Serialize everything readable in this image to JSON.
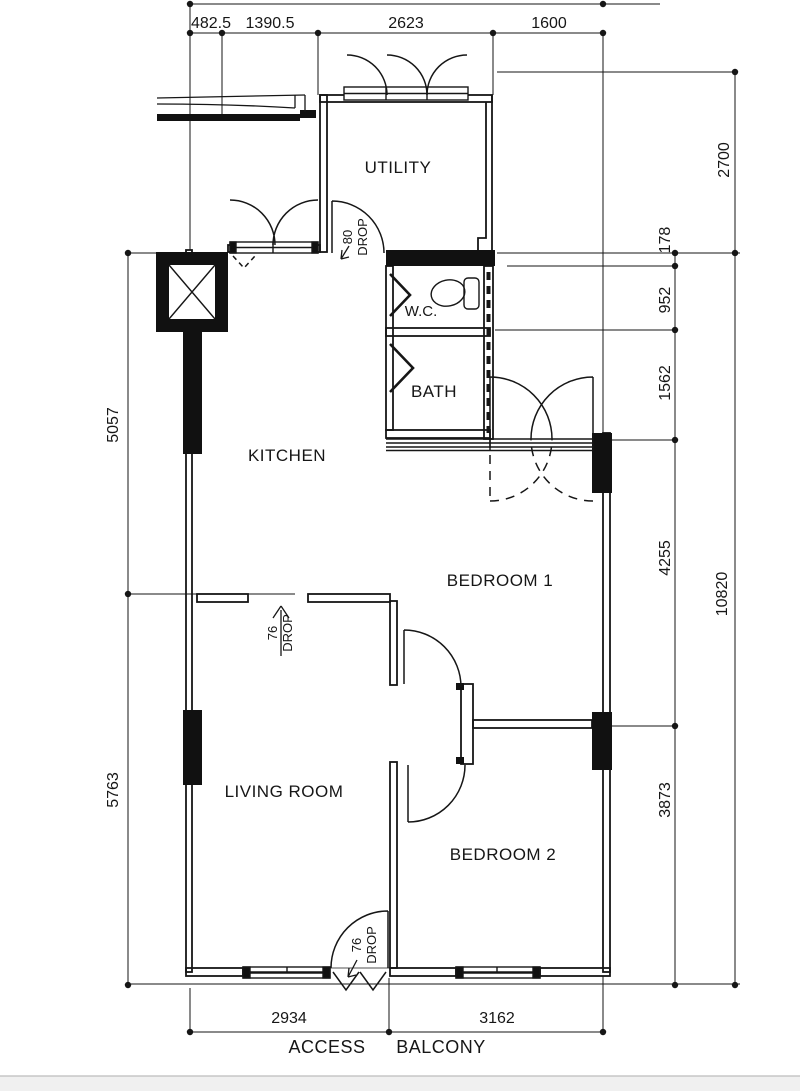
{
  "plan": {
    "title": "2-bedroom flat floor plan",
    "rooms": {
      "utility": "UTILITY",
      "kitchen": "KITCHEN",
      "wc": "W.C.",
      "bath": "BATH",
      "bedroom1": "BEDROOM 1",
      "bedroom2": "BEDROOM 2",
      "living": "LIVING ROOM"
    },
    "zones": {
      "access": "ACCESS",
      "balcony": "BALCONY"
    },
    "dimensions": {
      "top": [
        "482.5",
        "1390.5",
        "2623",
        "1600"
      ],
      "left": [
        "5057",
        "5763"
      ],
      "right_outer": [
        "2700",
        "10820"
      ],
      "right_inner": [
        "178",
        "952",
        "1562",
        "4255",
        "3873"
      ],
      "bottom": [
        "2934",
        "3162"
      ]
    },
    "drops": {
      "utility_value": "80",
      "utility_word": "DROP",
      "kitchen_value": "76",
      "kitchen_word": "DROP",
      "entry_value": "76",
      "entry_word": "DROP"
    },
    "colors": {
      "line": "#161616",
      "footer_bar": "#f0f0f0",
      "footer_edge": "#bcbcbc"
    }
  }
}
